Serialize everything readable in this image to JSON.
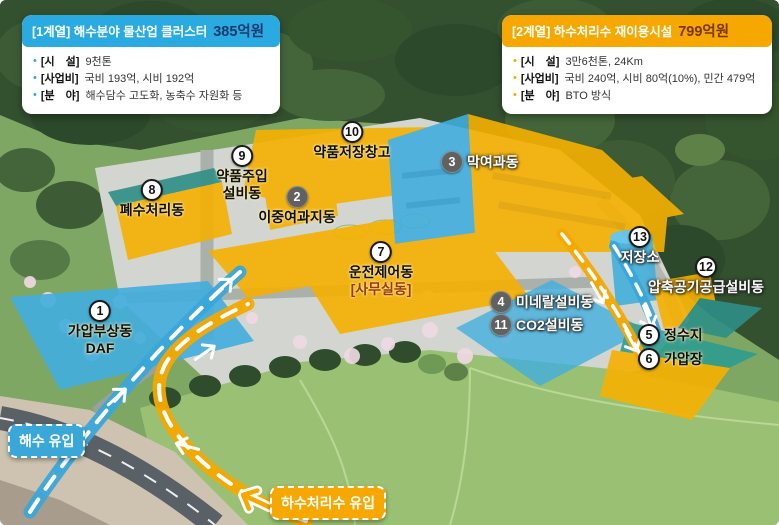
{
  "colors": {
    "seawater_flow": "#3aa7d9",
    "wastewater_flow": "#f6a800",
    "overlay_blue": "#41aede",
    "overlay_yellow": "#f6b100",
    "overlay_teal": "#2f9d8f",
    "marker_badge_dark": "#616161"
  },
  "info_boxes": [
    {
      "title": "[1계열] 해수분야 물산업 클러스터",
      "amount": "385억원",
      "header_color": "#29abe2",
      "amount_color": "#173a70",
      "bullet_color": "#29abe2",
      "items": [
        {
          "label": "[시　설]",
          "value": "9천톤"
        },
        {
          "label": "[사업비]",
          "value": "국비 193억, 시비 192억"
        },
        {
          "label": "[분　야]",
          "value": "해수담수 고도화, 농축수 자원화 등"
        }
      ]
    },
    {
      "title": "[2계열] 하수처리수 재이용시설",
      "amount": "799억원",
      "header_color": "#f6a800",
      "amount_color": "#7c3500",
      "bullet_color": "#f6a800",
      "items": [
        {
          "label": "[시　설]",
          "value": "3만6천톤, 24Km"
        },
        {
          "label": "[사업비]",
          "value": "국비 240억, 시비 80억(10%), 민간 479억"
        },
        {
          "label": "[분　야]",
          "value": "BTO 방식"
        }
      ]
    }
  ],
  "flow_badges": {
    "seawater": {
      "label": "해수 유입",
      "color": "#3aa7d9"
    },
    "wastewater": {
      "label": "하수처리수 유입",
      "color": "#f6a800"
    }
  },
  "markers": [
    {
      "num": "1",
      "layout": "stack",
      "badge": "light",
      "text": "dark",
      "x": 100,
      "y": 300,
      "lines": [
        {
          "text": "가압부상동"
        },
        {
          "text": "DAF"
        }
      ]
    },
    {
      "num": "2",
      "layout": "stack",
      "badge": "dark",
      "text": "dark",
      "x": 297,
      "y": 186,
      "lines": [
        {
          "text": "이중여과지동"
        }
      ]
    },
    {
      "num": "3",
      "layout": "inline",
      "badge": "dark",
      "text": "light",
      "x": 441,
      "y": 151,
      "lines": [
        {
          "text": "막여과동"
        }
      ]
    },
    {
      "num": "4",
      "layout": "inline",
      "badge": "dark",
      "text": "light",
      "x": 490,
      "y": 291,
      "lines": [
        {
          "text": "미네랄설비동"
        }
      ]
    },
    {
      "num": "5",
      "layout": "inline",
      "badge": "light",
      "text": "dark",
      "x": 638,
      "y": 324,
      "lines": [
        {
          "text": "정수지"
        }
      ]
    },
    {
      "num": "6",
      "layout": "inline",
      "badge": "light",
      "text": "dark",
      "x": 638,
      "y": 348,
      "lines": [
        {
          "text": "가압장"
        }
      ]
    },
    {
      "num": "7",
      "layout": "stack",
      "badge": "light",
      "text": "dark",
      "x": 381,
      "y": 241,
      "lines": [
        {
          "text": "운전제어동"
        },
        {
          "text": "[사무실동]",
          "color": "#9c3a00"
        }
      ]
    },
    {
      "num": "8",
      "layout": "stack",
      "badge": "light",
      "text": "dark",
      "x": 152,
      "y": 179,
      "lines": [
        {
          "text": "폐수처리동"
        }
      ]
    },
    {
      "num": "9",
      "layout": "stack",
      "badge": "light",
      "text": "dark",
      "x": 242,
      "y": 145,
      "lines": [
        {
          "text": "약품주입"
        },
        {
          "text": "설비동"
        }
      ]
    },
    {
      "num": "10",
      "layout": "stack",
      "badge": "light",
      "text": "dark",
      "x": 352,
      "y": 121,
      "lines": [
        {
          "text": "약품저장창고"
        }
      ]
    },
    {
      "num": "11",
      "layout": "inline",
      "badge": "dark",
      "text": "light",
      "x": 490,
      "y": 314,
      "lines": [
        {
          "text": "CO2설비동"
        }
      ]
    },
    {
      "num": "12",
      "layout": "stack",
      "badge": "light",
      "text": "light",
      "x": 706,
      "y": 256,
      "lines": [
        {
          "text": "압축공기공급설비동"
        }
      ]
    },
    {
      "num": "13",
      "layout": "stack",
      "badge": "light",
      "text": "light",
      "x": 640,
      "y": 226,
      "lines": [
        {
          "text": "저장소"
        }
      ]
    }
  ]
}
